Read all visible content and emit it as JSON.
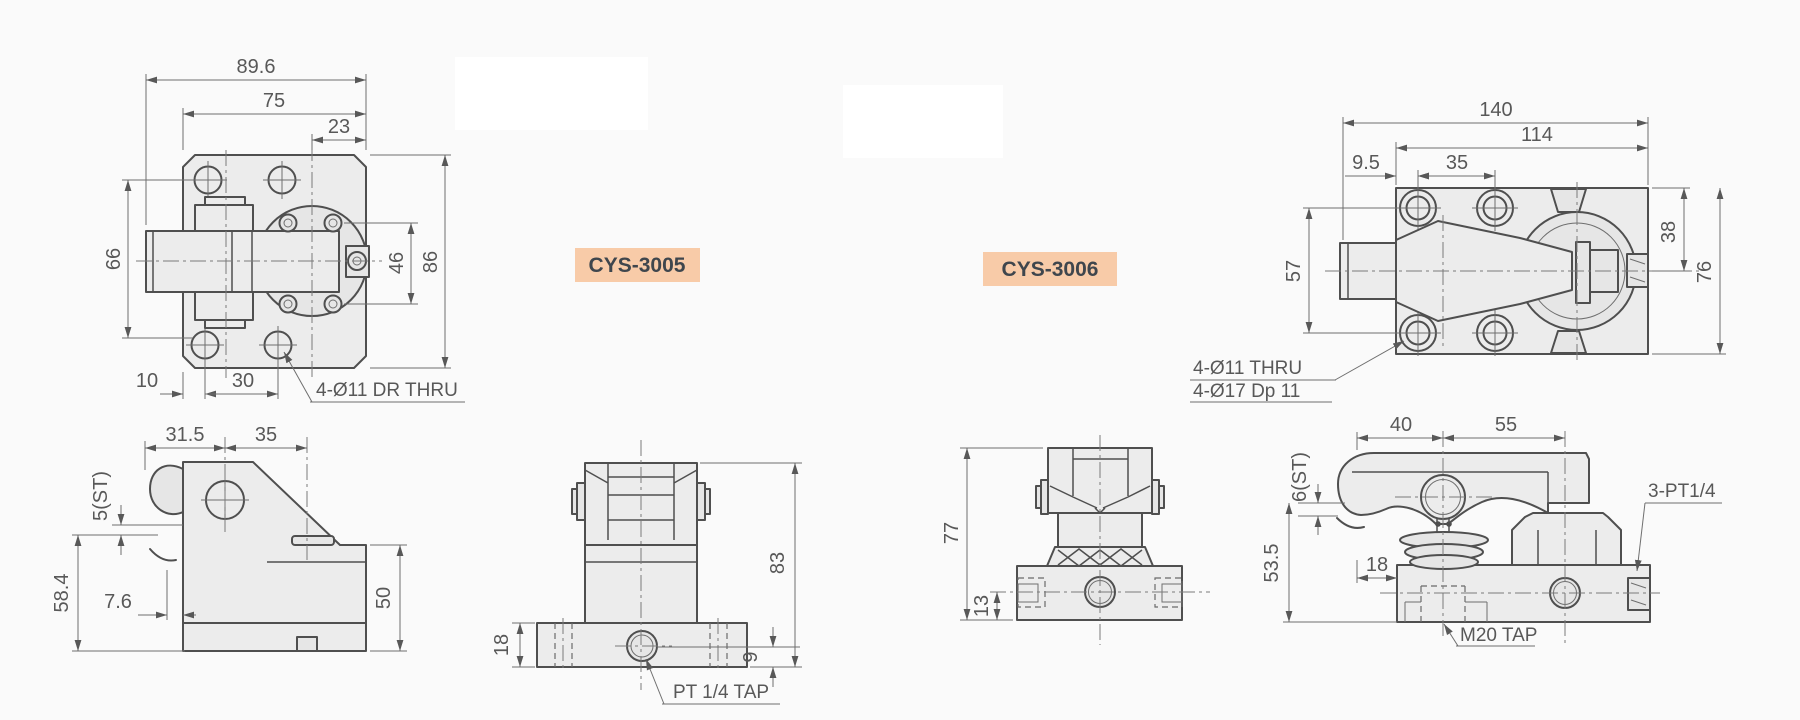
{
  "page": {
    "background": "#fafafa",
    "line_color": "#4f4f4f",
    "dim_color": "#585858",
    "part_fill": "#ececec",
    "label_bg": "#f8cba8",
    "label_fg": "#3f464d"
  },
  "products": [
    {
      "label": "CYS-3005",
      "views": {
        "top": {
          "dims": {
            "overall_width": "89.6",
            "body_width": "75",
            "boss_offset": "23",
            "left_span": "66",
            "screw_span": "46",
            "overall_height": "86",
            "edge_to_hole": "10",
            "hole_pitch": "30"
          },
          "callouts": {
            "holes": "4-Ø11 DR THRU"
          }
        },
        "front": {
          "dims": {
            "arm_back": "31.5",
            "arm_front": "35",
            "stroke": "5(ST)",
            "open_height": "58.4",
            "lip": "7.6",
            "body_height": "50"
          }
        },
        "side": {
          "dims": {
            "flange_height": "18",
            "total_height": "83",
            "port_height": "9"
          },
          "callouts": {
            "port": "PT 1/4 TAP"
          }
        }
      }
    },
    {
      "label": "CYS-3006",
      "views": {
        "top": {
          "dims": {
            "overall_width": "140",
            "plate_width": "114",
            "edge_to_hole": "9.5",
            "hole_pitch": "35",
            "hole_span": "57",
            "port_offset": "38",
            "plate_height": "76"
          },
          "callouts": {
            "holes_line1": "4-Ø11  THRU",
            "holes_line2": "4-Ø17  Dp 11"
          }
        },
        "front": {
          "dims": {
            "total_height": "77",
            "port_height": "13"
          }
        },
        "side": {
          "dims": {
            "arm_back": "40",
            "arm_front": "55",
            "stroke": "6(ST)",
            "clamp_height": "53.5",
            "edge_offset": "18"
          },
          "callouts": {
            "ports": "3-PT1/4",
            "tap": "M20 TAP"
          }
        }
      }
    }
  ]
}
